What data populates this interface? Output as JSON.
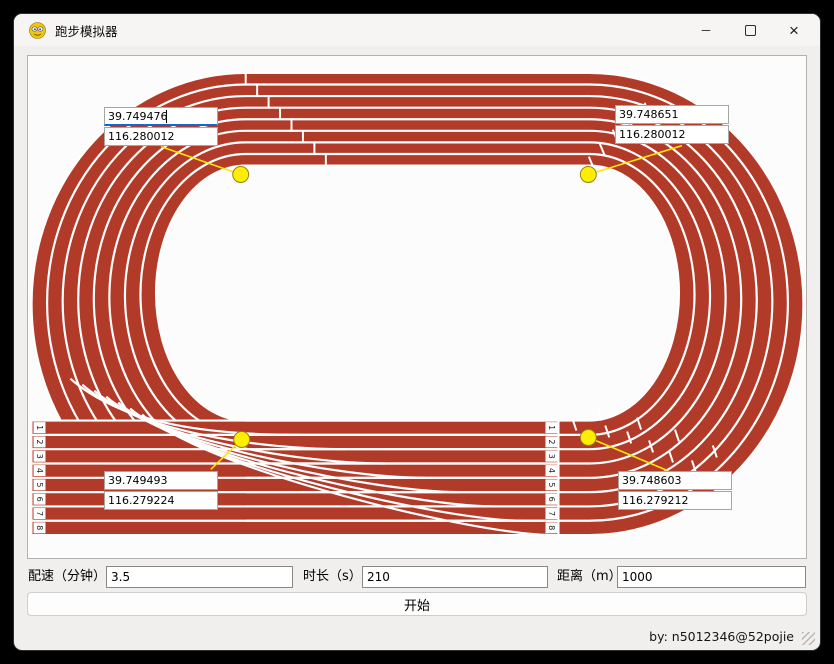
{
  "window": {
    "title": "跑步模拟器",
    "controls": {
      "minimize": "─",
      "maximize": "maximize-box",
      "close": "×"
    }
  },
  "canvas": {
    "markers": [
      {
        "position": "top-left",
        "lat": "39.749476",
        "lon": "116.280012",
        "focused": true
      },
      {
        "position": "top-right",
        "lat": "39.748651",
        "lon": "116.280012",
        "focused": false
      },
      {
        "position": "bottom-left",
        "lat": "39.749493",
        "lon": "116.279224",
        "focused": false
      },
      {
        "position": "bottom-right",
        "lat": "39.748603",
        "lon": "116.279212",
        "focused": false
      }
    ],
    "lane_numbers": [
      "1",
      "2",
      "3",
      "4",
      "5",
      "6",
      "7",
      "8"
    ],
    "colors": {
      "track_red": "#b23a28",
      "lane_white": "#ffffff",
      "marker_yellow": "#ffee00",
      "connector_yellow": "#ffe40a",
      "focus_blue": "#1765cf"
    }
  },
  "form": {
    "pace": {
      "label": "配速（分钟）:",
      "value": "3.5"
    },
    "duration": {
      "label": "时长（s）:",
      "value": "210"
    },
    "distance": {
      "label": "距离（m）:",
      "value": "1000"
    },
    "start_label": "开始"
  },
  "statusbar": {
    "credit": "by: n5012346@52pojie"
  }
}
